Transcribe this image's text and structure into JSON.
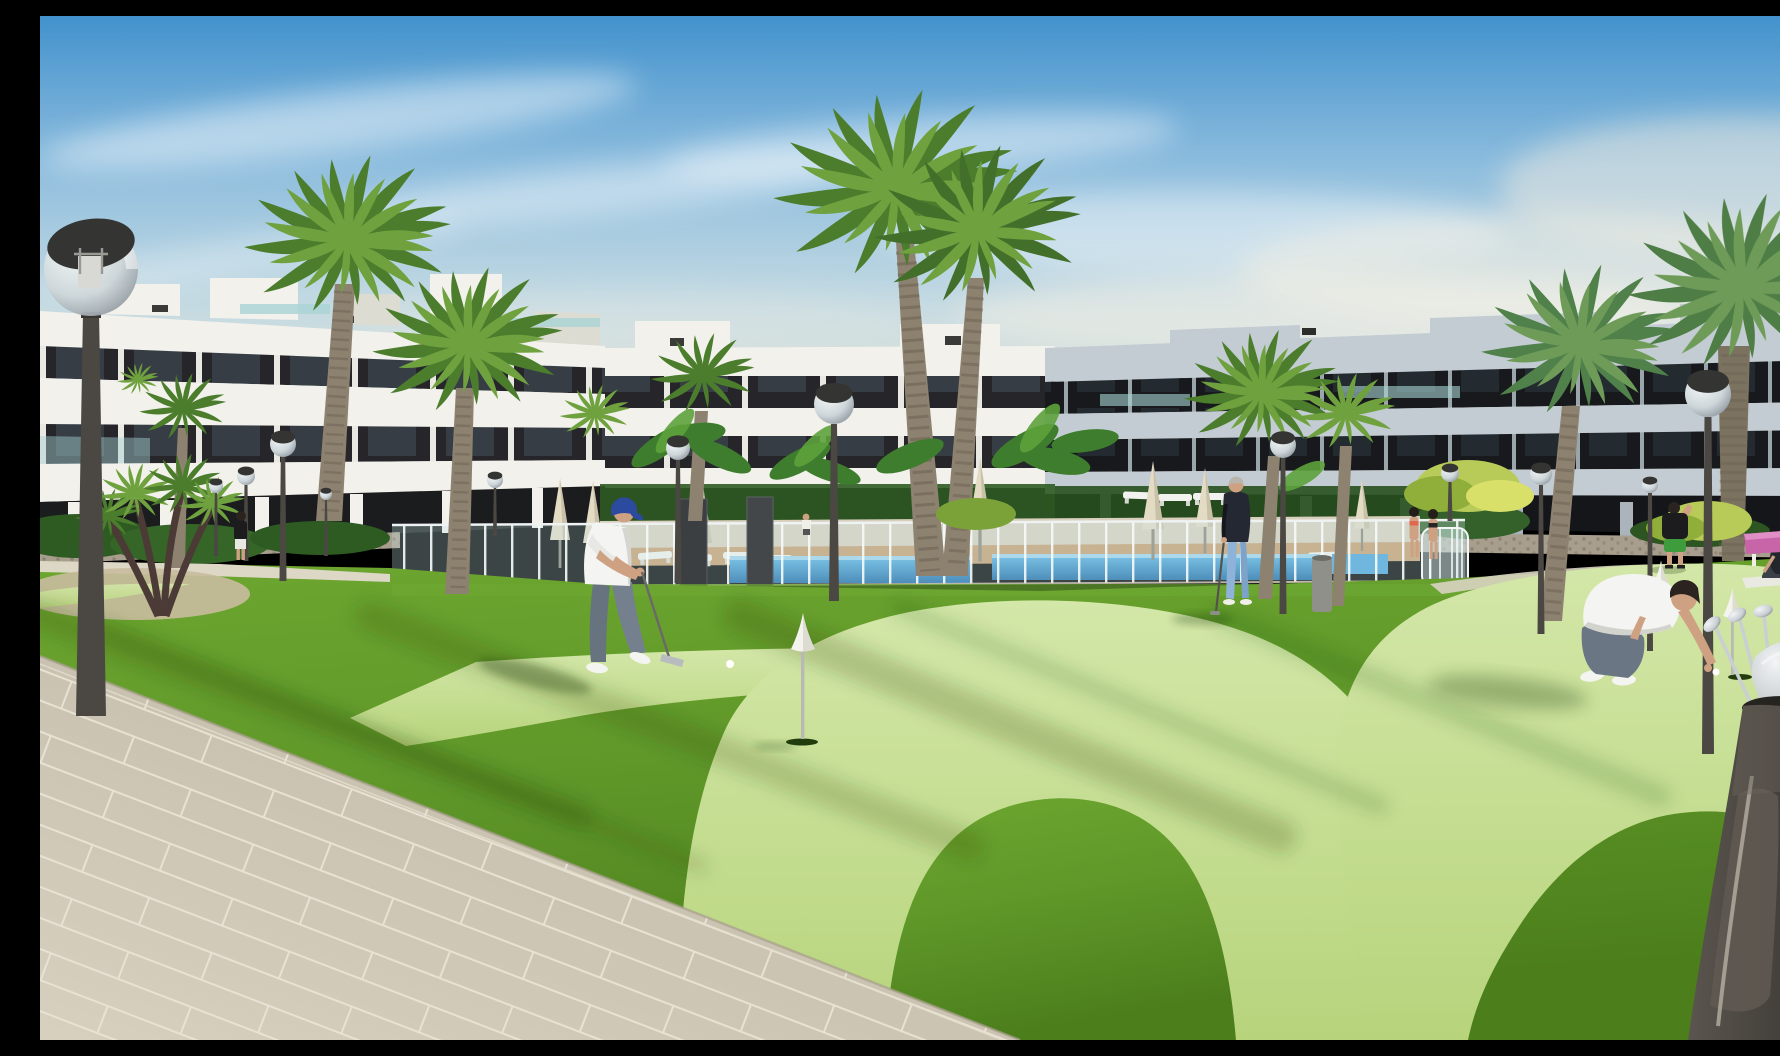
{
  "scene": {
    "description": "Photorealistic architectural rendering of a modern white apartment complex courtyard with a communal mini-golf putting green, swimming pool behind a glass fence, palm trees and globe street lamps in warm afternoon light.",
    "setting": "residential resort courtyard with putting green and pool",
    "objects": [
      "apartment-buildings",
      "swimming-pool",
      "glass-pool-fence",
      "putting-green",
      "palm-trees",
      "globe-street-lamps",
      "closed-parasols",
      "sun-loungers",
      "white-cone-hole-markers",
      "golf-balls",
      "golf-bag-with-clubs",
      "tiled-walkway",
      "pink-bench",
      "yoga-mat",
      "waste-bin",
      "shrubs"
    ],
    "people": [
      {
        "name": "golfer-putting",
        "clothing": "white polo, grey jeans, navy cap"
      },
      {
        "name": "senior-man-with-club",
        "clothing": "dark sweater, light blue trousers"
      },
      {
        "name": "crouching-golfer",
        "clothing": "white t-shirt, grey jeans"
      },
      {
        "name": "man-stretching",
        "clothing": "black t-shirt, green shorts"
      },
      {
        "name": "woman-doing-yoga",
        "clothing": "dark activewear on white mat"
      },
      {
        "name": "two-women-at-pool-fence",
        "clothing": "swimwear"
      },
      {
        "name": "man-near-building",
        "clothing": "black t-shirt, white shorts"
      }
    ]
  },
  "palette": {
    "sky_top": "#4292cd",
    "sky_mid": "#8fbede",
    "sky_low": "#c0d8e2",
    "sky_warm": "#ece8d8",
    "cloud": "#ffffff",
    "bldg_white": "#f2f1ec",
    "bldg_shade": "#dcdcd2",
    "band_dark": "#26262a",
    "band_dark_right": "#17191c",
    "slab_right": "#c3ccd2",
    "glass_teal": "#a9d3d4",
    "stone": "#a89e8e",
    "deck_tan": "#c79d6f",
    "deck_light": "#d8d0bd",
    "pool_blue": "#2f8fd2",
    "pool_blue_deep": "#1968a8",
    "grass_dark": "#4c7f1c",
    "grass_main": "#67a02b",
    "grass_light": "#79b23a",
    "green_light": "#c3dd8e",
    "green_light2": "#d3e7a8",
    "tile": "#cfc7b6",
    "grout": "#e8e2d4",
    "pole": "#4b4743",
    "globe_cap": "#343432",
    "trunk": "#8d8270",
    "trunk_dark": "#6e6354",
    "frond": "#4b7d2d",
    "frond_light": "#6fa23e",
    "frond_yellow": "#b8cb58",
    "skin": "#cfa183",
    "cap_blue": "#2b4aa0",
    "jeans": "#74808e",
    "shirt_white": "#f4f4f2",
    "sweater_dark": "#242832",
    "pants_blue": "#8fb3d8",
    "shorts_green": "#3f9c3c",
    "top_black": "#1c1c1e",
    "bag": "#4f4a44",
    "chrome": "#c9ced2",
    "pink": "#c765a8",
    "mat": "#e9e9e2",
    "bin": "#90908a"
  }
}
